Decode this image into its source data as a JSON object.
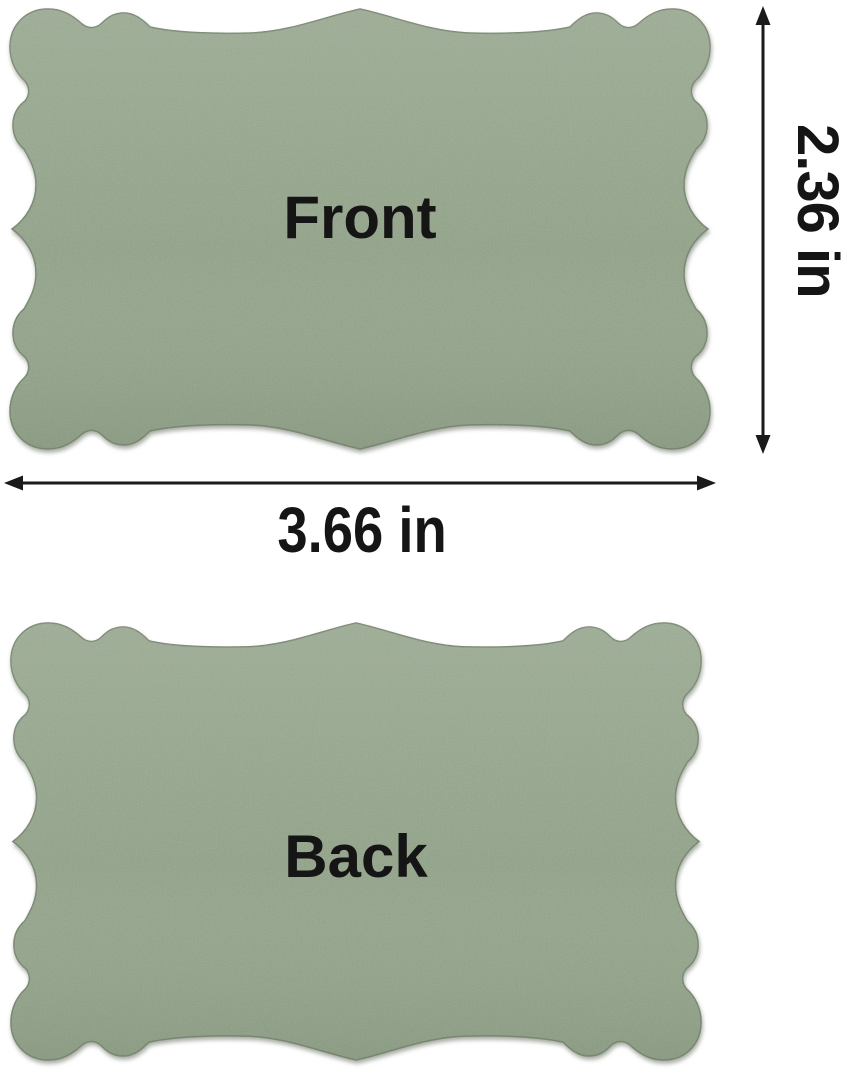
{
  "cards": {
    "front_label": "Front",
    "back_label": "Back"
  },
  "dimensions": {
    "height_label": "2.36 in",
    "width_label": "3.66 in"
  },
  "colors": {
    "background": "#ffffff",
    "card": "#93a489",
    "card_edge": "#75846c",
    "text": "#151515",
    "arrow": "#1a1a1a"
  }
}
